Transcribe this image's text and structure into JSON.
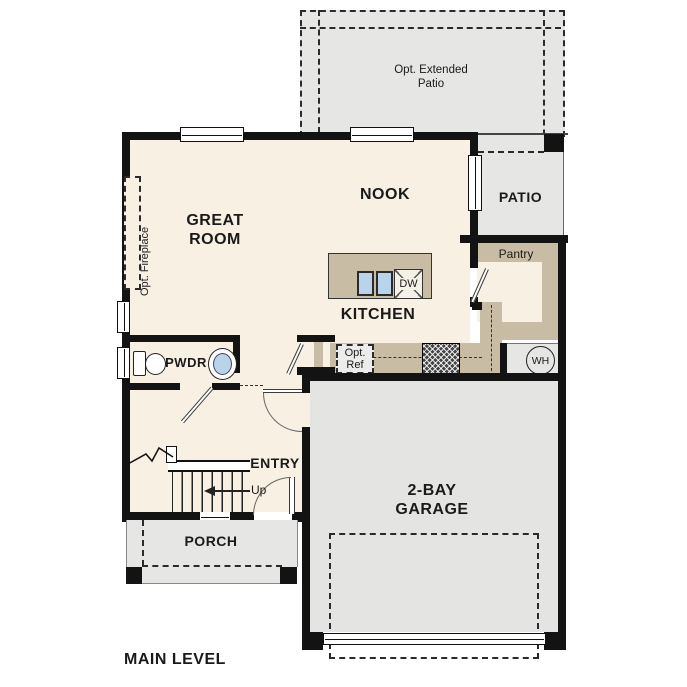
{
  "plan": {
    "title": "MAIN LEVEL",
    "rooms": {
      "great_room": "GREAT\nROOM",
      "nook": "NOOK",
      "kitchen": "KITCHEN",
      "patio": "PATIO",
      "pantry": "Pantry",
      "pwdr": "PWDR",
      "entry": "ENTRY",
      "porch": "PORCH",
      "garage": "2-BAY\nGARAGE"
    },
    "options": {
      "extended_patio": "Opt. Extended\nPatio",
      "fireplace": "Opt. Fireplace",
      "refrigerator": "Opt.\nRef"
    },
    "fixtures": {
      "water_heater": "WH",
      "dishwasher": "DW"
    },
    "stairs": {
      "direction": "Up"
    },
    "colors": {
      "floor": "#f8f0e3",
      "concrete": "#e6e6e4",
      "counter": "#c8bca4",
      "sink_blue": "#b9d3ea",
      "wall": "#131313"
    }
  }
}
